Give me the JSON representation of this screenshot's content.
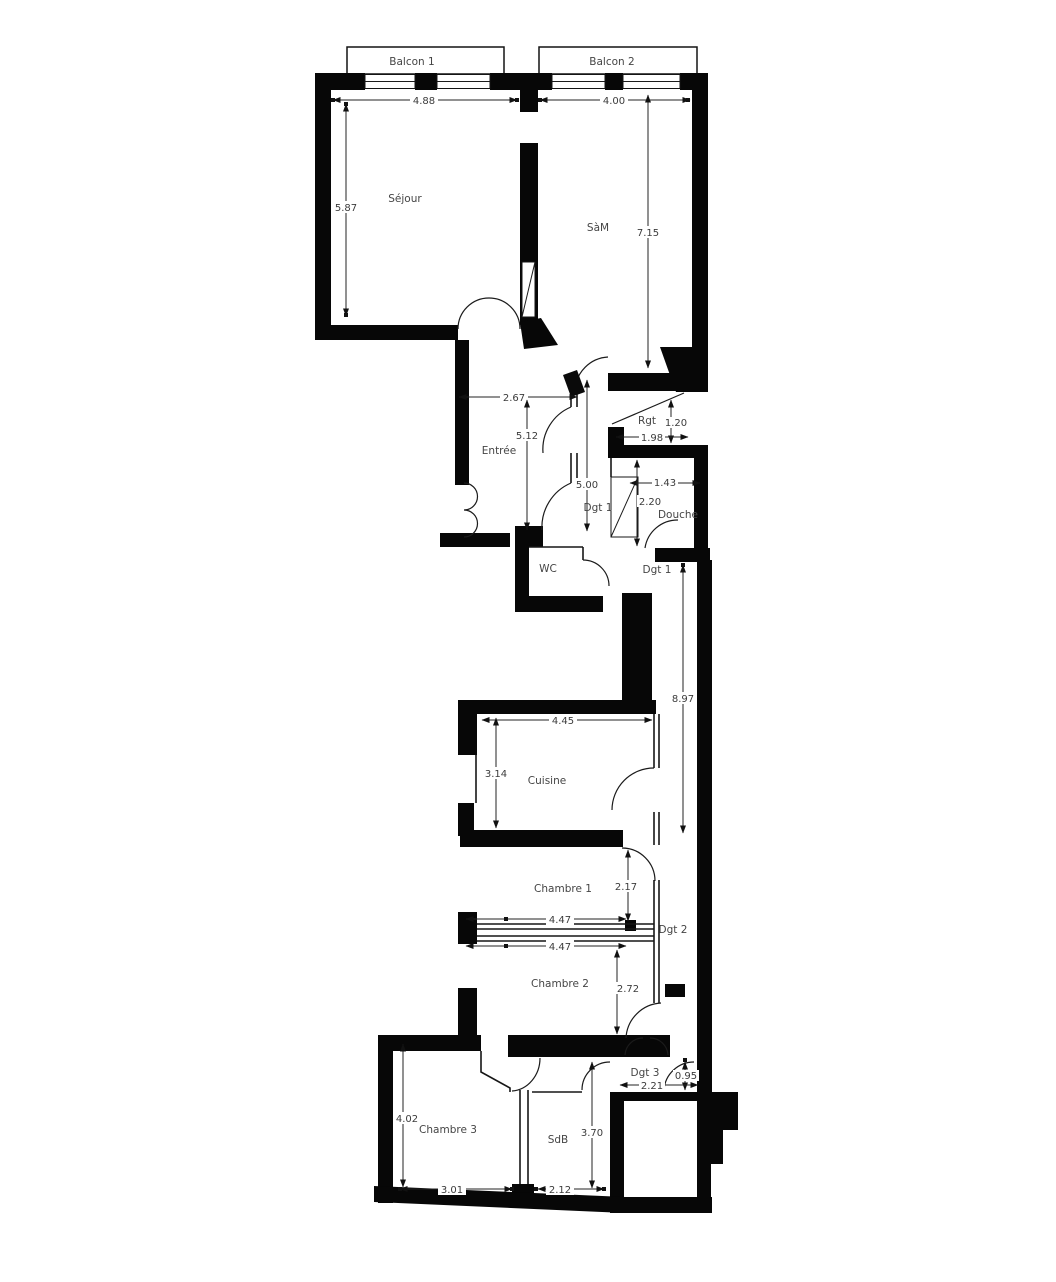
{
  "plan_title": "Floor plan",
  "rooms": {
    "balcon1": "Balcon 1",
    "balcon2": "Balcon 2",
    "sejour": "Séjour",
    "sam": "SàM",
    "entree": "Entrée",
    "wc": "WC",
    "rgt": "Rgt",
    "douche": "Douche",
    "dgt1a": "Dgt 1",
    "dgt1b": "Dgt 1",
    "cuisine": "Cuisine",
    "chambre1": "Chambre 1",
    "dgt2": "Dgt 2",
    "chambre2": "Chambre 2",
    "dgt3": "Dgt 3",
    "chambre3": "Chambre 3",
    "sdb": "SdB"
  },
  "dimensions": {
    "balcon1_width": "4.88",
    "balcon2_width": "4.00",
    "sejour_height": "5.87",
    "sam_height": "7.15",
    "entree_width": "2.67",
    "entree_height": "5.12",
    "dgt1_length": "5.00",
    "rgt_height": "1.20",
    "rgt_width": "1.98",
    "douche_width": "1.43",
    "douche_height": "2.20",
    "corridor_length": "8.97",
    "cuisine_width": "4.45",
    "cuisine_height": "3.14",
    "chambre1_height": "2.17",
    "chambre1_width": "4.47",
    "chambre2_width": "4.47",
    "chambre2_height": "2.72",
    "dgt3_height": "0.95",
    "dgt3_width": "2.21",
    "chambre3_height": "4.02",
    "chambre3_width": "3.01",
    "sdb_height": "3.70",
    "sdb_width": "2.12"
  },
  "colors": {
    "wall": "#070707",
    "background": "#ffffff",
    "text": "#3c3c3c"
  }
}
